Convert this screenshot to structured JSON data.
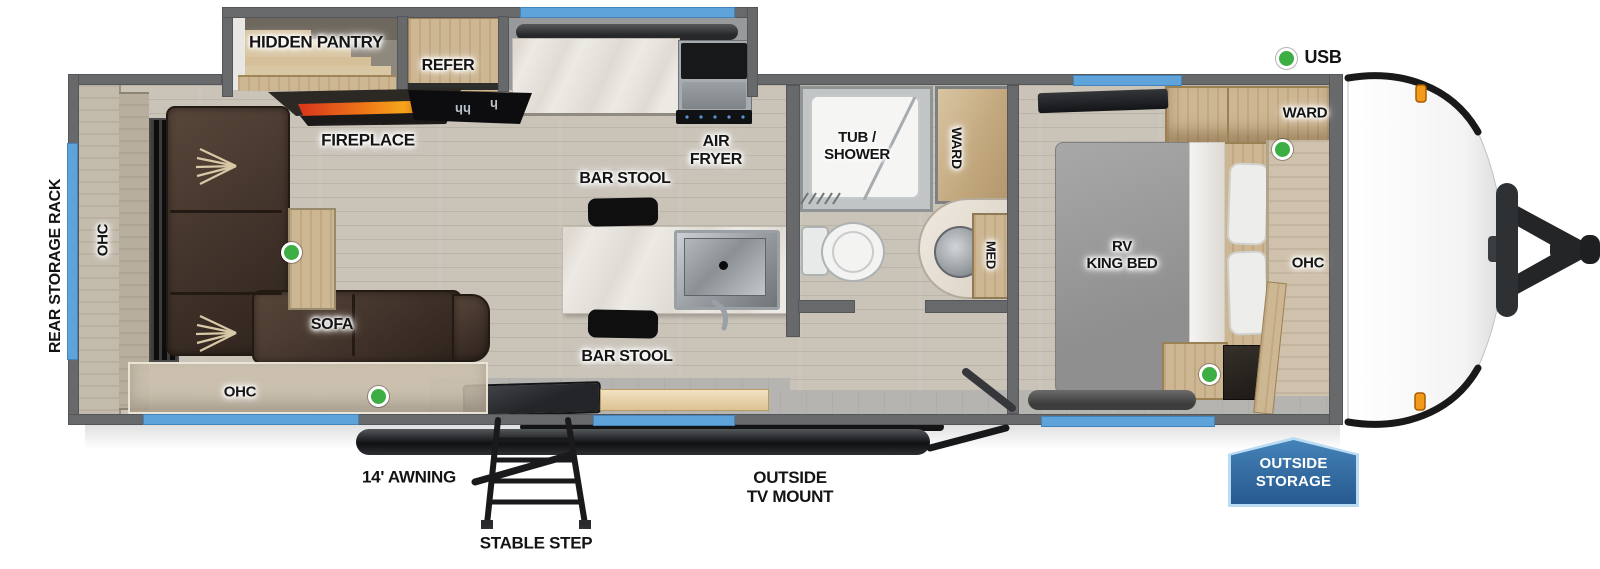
{
  "labels": {
    "hidden_pantry": "HIDDEN PANTRY",
    "refer": "REFER",
    "fireplace": "FIREPLACE",
    "air_fryer": [
      "AIR",
      "FRYER"
    ],
    "bar_stool": "BAR STOOL",
    "tub_shower": [
      "TUB /",
      "SHOWER"
    ],
    "ward": "WARD",
    "med": "MED",
    "rv_king_bed": [
      "RV",
      "KING BED"
    ],
    "ohc": "OHC",
    "sofa": "SOFA",
    "rear_storage_rack": "REAR STORAGE RACK",
    "usb": "USB",
    "awning": "14' AWNING",
    "stable_step": "STABLE STEP",
    "outside_tv_mount": [
      "OUTSIDE",
      "TV MOUNT"
    ],
    "outside_storage": [
      "OUTSIDE",
      "STORAGE"
    ]
  },
  "colors": {
    "window_blue": "#5ea3da",
    "wall_gray": "#67696b",
    "indicator_green": "#3cae44",
    "badge_blue": "#2f6ba8",
    "flame_orange": "#f07818",
    "sofa_brown": "#4a392c"
  }
}
